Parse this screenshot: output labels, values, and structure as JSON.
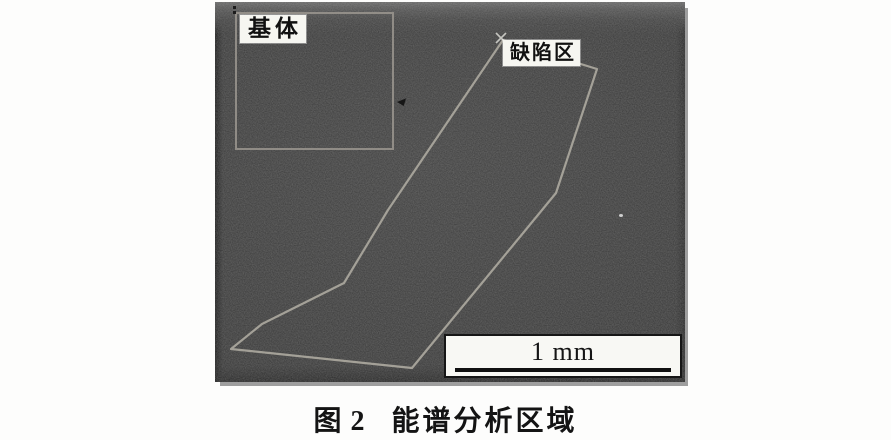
{
  "figure": {
    "micrograph": {
      "bg_color": "#414141",
      "outline_color": "#a9a59c",
      "region_box_color": "#9b978f",
      "matrix_label": "基体",
      "defect_label": "缺陷区",
      "scale_bar_label": "1 mm"
    },
    "caption": {
      "number": "图 2",
      "title": "能谱分析区域"
    }
  }
}
